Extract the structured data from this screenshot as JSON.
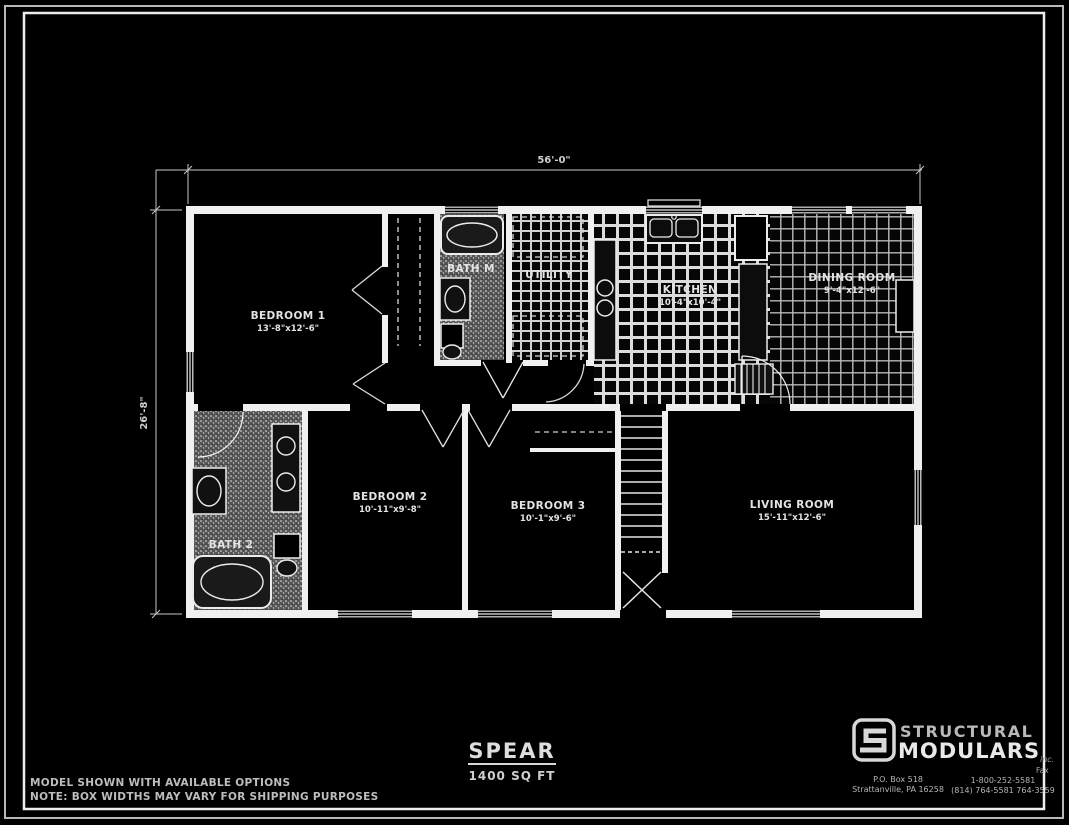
{
  "colors": {
    "background": "#000000",
    "line": "#f0f0f0",
    "dim_text": "#cfcfcf"
  },
  "dimensions": {
    "overall_width": "56'-0\"",
    "overall_depth": "26'-8\""
  },
  "rooms": {
    "bedroom1": {
      "name": "BEDROOM 1",
      "dims": "13'-8\"x12'-6\""
    },
    "bath1": {
      "name": "BATH M"
    },
    "utility": {
      "name": "UTILITY"
    },
    "kitchen": {
      "name": "KITCHEN",
      "dims": "10'-4\"x10'-4\""
    },
    "dining": {
      "name": "DINING ROOM",
      "dims": "9'-4\"x12'-6\""
    },
    "bath2": {
      "name": "BATH 2"
    },
    "bedroom2": {
      "name": "BEDROOM 2",
      "dims": "10'-11\"x9'-8\""
    },
    "bedroom3": {
      "name": "BEDROOM 3",
      "dims": "10'-1\"x9'-6\""
    },
    "living": {
      "name": "LIVING ROOM",
      "dims": "15'-11\"x12'-6\""
    }
  },
  "title_block": {
    "model_name": "SPEAR",
    "area": "1400 SQ FT"
  },
  "notes": {
    "line1": "MODEL SHOWN WITH AVAILABLE OPTIONS",
    "line2": "NOTE: BOX WIDTHS MAY VARY FOR SHIPPING PURPOSES"
  },
  "branding": {
    "name_top": "STRUCTURAL",
    "name_bottom": "MODULARS",
    "suffix": "inc.",
    "address_line1": "P.O. Box 518",
    "address_line2": "Strattanville, PA  16258",
    "fax_label": "Fax",
    "phone_line1": "1-800-252-5581",
    "phone_line2": "(814) 764-5581  764-3559"
  }
}
